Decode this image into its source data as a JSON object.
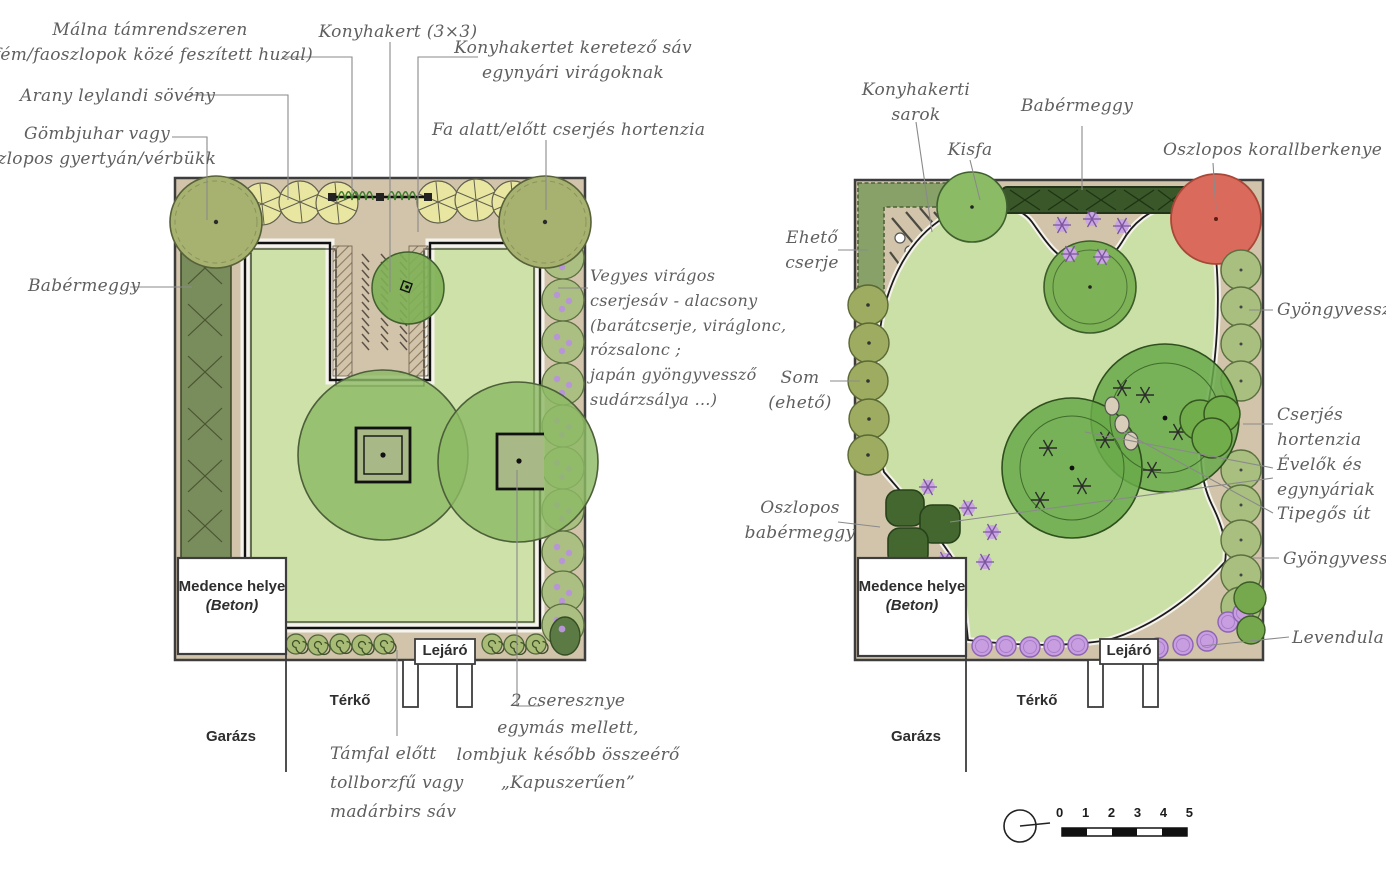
{
  "left_plan": {
    "annotations": {
      "malna": "Málna támrendszeren\n(fém/faoszlopok közé feszített huzal)",
      "konyhakert": "Konyhakert (3×3)",
      "keretezo_sav": "Konyhakertet keretező sáv\negynyári virágoknak",
      "leylandi": "Arany leylandi sövény",
      "gombjuhar": "Gömbjuhar vagy\noszlopos gyertyán/vérbükk",
      "fa_alatt": "Fa alatt/előtt cserjés hortenzia",
      "babermeggy": "Babérmeggy",
      "vegyes": "Vegyes virágos\ncserjesáv - alacsony\n(barátcserje, viráglonc,\nrózsalonc ;\njapán gyöngyvessző\nsudárzsálya …)",
      "tamfal": "Támfal előtt\ntollborzfű vagy\nmadárbirs sáv",
      "cseresznye": "2 cseresznye\negymás mellett,\nlombjuk később összeérő\n„Kapuszerűen”"
    }
  },
  "right_plan": {
    "annotations": {
      "konyhakerti_sarok": "Konyhakerti\nsarok",
      "kisfa": "Kisfa",
      "babermeggy": "Babérmeggy",
      "korallberkenye": "Oszlopos korallberkenye",
      "eheto_cserje": "Ehető\ncserje",
      "som": "Som\n(ehető)",
      "oszlopos_babermeggy": "Oszlopos\nbabérmeggy",
      "gyongyvesszo_felso": "Gyöngyvessző",
      "cserjes_hortenzia": "Cserjés\nhortenzia",
      "evelok": "Évelők és\negynyáriak",
      "tipegos_ut": "Tipegős út",
      "gyongyvesszo_also": "Gyöngyvessző",
      "levendula": "Levendula"
    }
  },
  "shared_labels": {
    "pool_title": "Medence helye",
    "pool_material": "(Beton)",
    "paving": "Térkő",
    "garage": "Garázs",
    "stairs": "Lejáró"
  },
  "scale_bar": {
    "ticks": [
      "0",
      "1",
      "2",
      "3",
      "4",
      "5"
    ]
  },
  "palette": {
    "soil_tan": "#d2c4ab",
    "lawn_green": "#cde1a9",
    "canopy_green": "#8cb964",
    "dark_hedge": "#3a572a",
    "olive_tree": "#a7b271",
    "yellow_shrub": "#e9e6a2",
    "red_tree": "#da6a5c",
    "lavender": "#c99ee1",
    "ink": "#3d3d3d",
    "handwriting_gray": "#5f5f5f"
  }
}
